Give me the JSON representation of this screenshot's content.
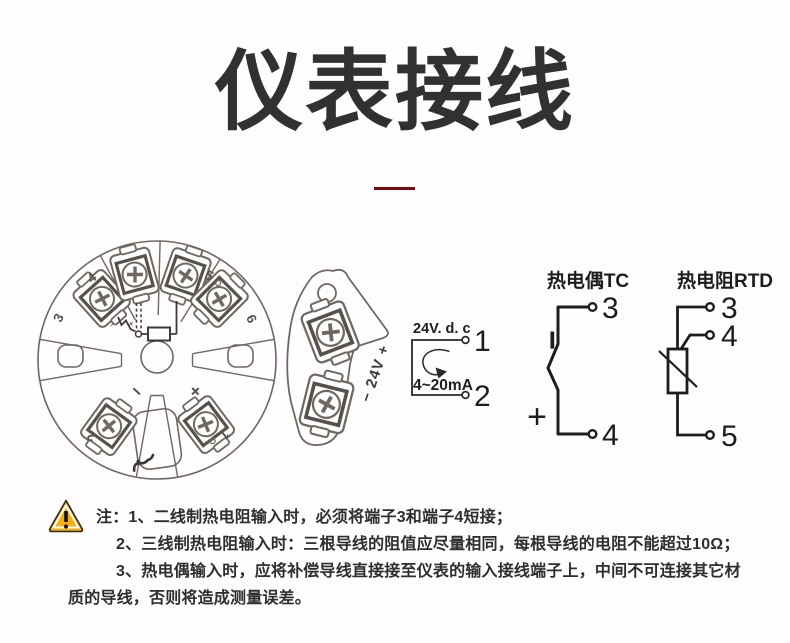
{
  "title": "仪表接线",
  "colors": {
    "accent_red": "#7c0a0a",
    "warning_orange": "#F7AD0B",
    "line_dark": "#1d1d1d",
    "drawing_gray": "#6f6862"
  },
  "module": {
    "label_1": "1",
    "label_2": "2",
    "label_3": "3",
    "label_4": "4",
    "label_5": "5",
    "label_6": "6",
    "minus": "−",
    "plus": "+",
    "sensor_minus": "−",
    "sensor_plus": "+"
  },
  "side_view": {
    "label": "− 24V +"
  },
  "loop": {
    "supply": "24V. d. c",
    "current": "4~20mA",
    "terminal_top": "1",
    "terminal_bottom": "2"
  },
  "tc": {
    "title": "热电偶TC",
    "terminal_top": "3",
    "terminal_bottom": "4",
    "minus": "−",
    "plus": "+"
  },
  "rtd": {
    "title": "热电阻RTD",
    "terminal_top": "3",
    "terminal_mid": "4",
    "terminal_bottom": "5"
  },
  "notes": {
    "line1": "注：1、二线制热电阻输入时，必须将端子3和端子4短接；",
    "line2": "2、三线制热电阻输入时：三根导线的阻值应尽量相同，每根导线的电阻不能超过10Ω；",
    "line3": "3、热电偶输入时，应将补偿导线直接接至仪表的输入接线端子上，中间不可连接其它材",
    "line4": "质的导线，否则将造成测量误差。"
  }
}
